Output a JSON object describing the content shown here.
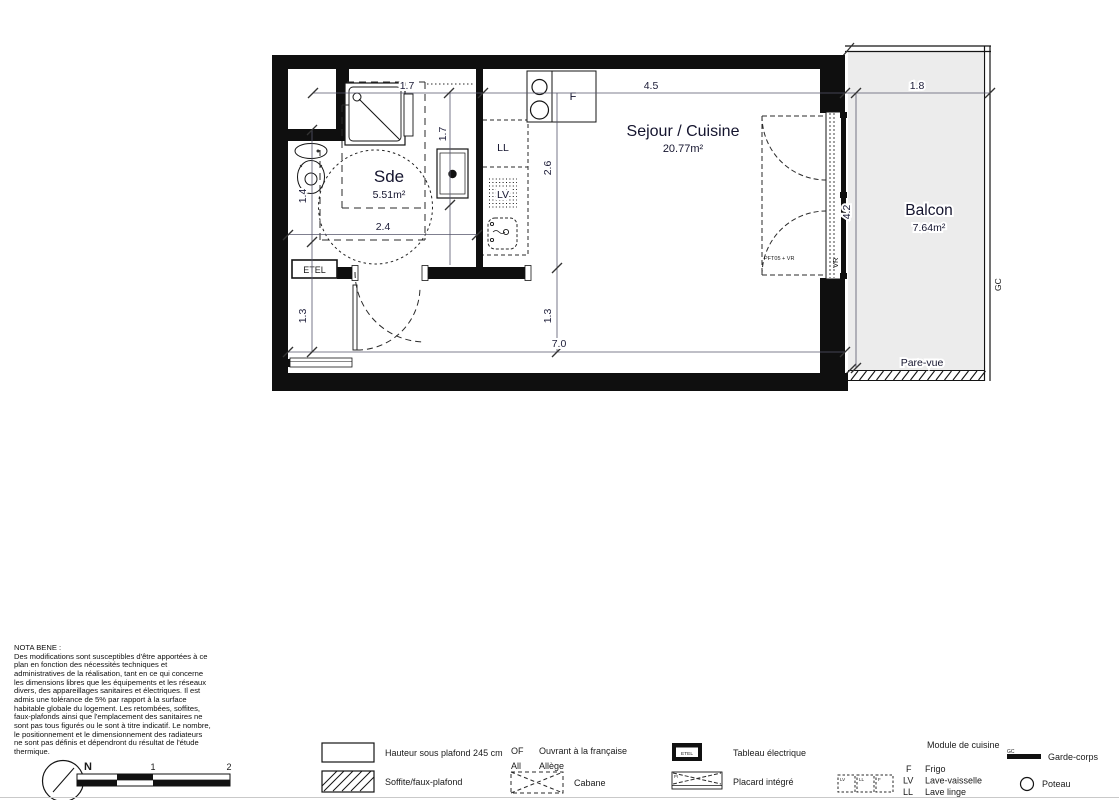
{
  "plan": {
    "rooms": {
      "sde": {
        "name": "Sde",
        "area": "5.51m²"
      },
      "sejour": {
        "name": "Sejour / Cuisine",
        "area": "20.77m²"
      },
      "balcon": {
        "name": "Balcon",
        "area": "7.64m²"
      }
    },
    "dims": {
      "shower_width": "1.7",
      "shower_depth": "1.7",
      "wc": "1.4",
      "sde_width": "2.4",
      "kitchen_depth": "2.6",
      "sejour_width": "4.5",
      "balcony_width": "1.8",
      "balcony_depth": "4.2",
      "hall_left": "1.3",
      "hall_mid": "1.3",
      "total_width": "7.0"
    },
    "labels": {
      "ll": "LL",
      "lv": "LV",
      "fridge": "F",
      "etel": "ETEL",
      "vr": "VR",
      "window_ref": "PFT05 + VR",
      "pare_vue": "Pare-vue",
      "gc": "GC"
    }
  },
  "nota": {
    "title": "NOTA BENE :",
    "body": "Des modifications sont susceptibles d'être apportées à ce plan en fonction des nécessités techniques et administratives de la réalisation, tant en ce qui concerne les dimensions libres que les équipements et les réseaux divers, des appareillages sanitaires et électriques. Il est admis une tolérance de 5% par rapport à la surface habitable globale du logement. Les retombées, soffites, faux-plafonds ainsi que l'emplacement des sanitaires ne sont pas tous figurés ou le sont à titre indicatif. Le nombre, le positionnement et le dimensionnement des radiateurs ne sont pas définis et dépendront du résultat de l'étude thermique."
  },
  "compass": {
    "north": "N"
  },
  "scale": {
    "one": "1",
    "two": "2"
  },
  "legend": {
    "ceiling_height": "Hauteur sous plafond 245 cm",
    "soffit": "Soffite/faux-plafond",
    "of_abbr": "OF",
    "of_label": "Ouvrant à la française",
    "allege_abbr": "All",
    "allege_label": "Allège",
    "cabane": "Cabane",
    "etel_box": "ETEL",
    "tableau": "Tableau électrique",
    "placard_pi": "PI",
    "placard": "Placard intégré",
    "module_title": "Module de cuisine",
    "module_box_lv": "LV",
    "module_box_ll": "LL",
    "module_box_f": "F",
    "frigo_abbr": "F",
    "frigo_label": "Frigo",
    "lv_abbr": "LV",
    "lv_label": "Lave-vaisselle",
    "ll_abbr": "LL",
    "ll_label": "Lave linge",
    "gc_abbr": "GC",
    "gc_label": "Garde-corps",
    "poteau_label": "Poteau"
  }
}
